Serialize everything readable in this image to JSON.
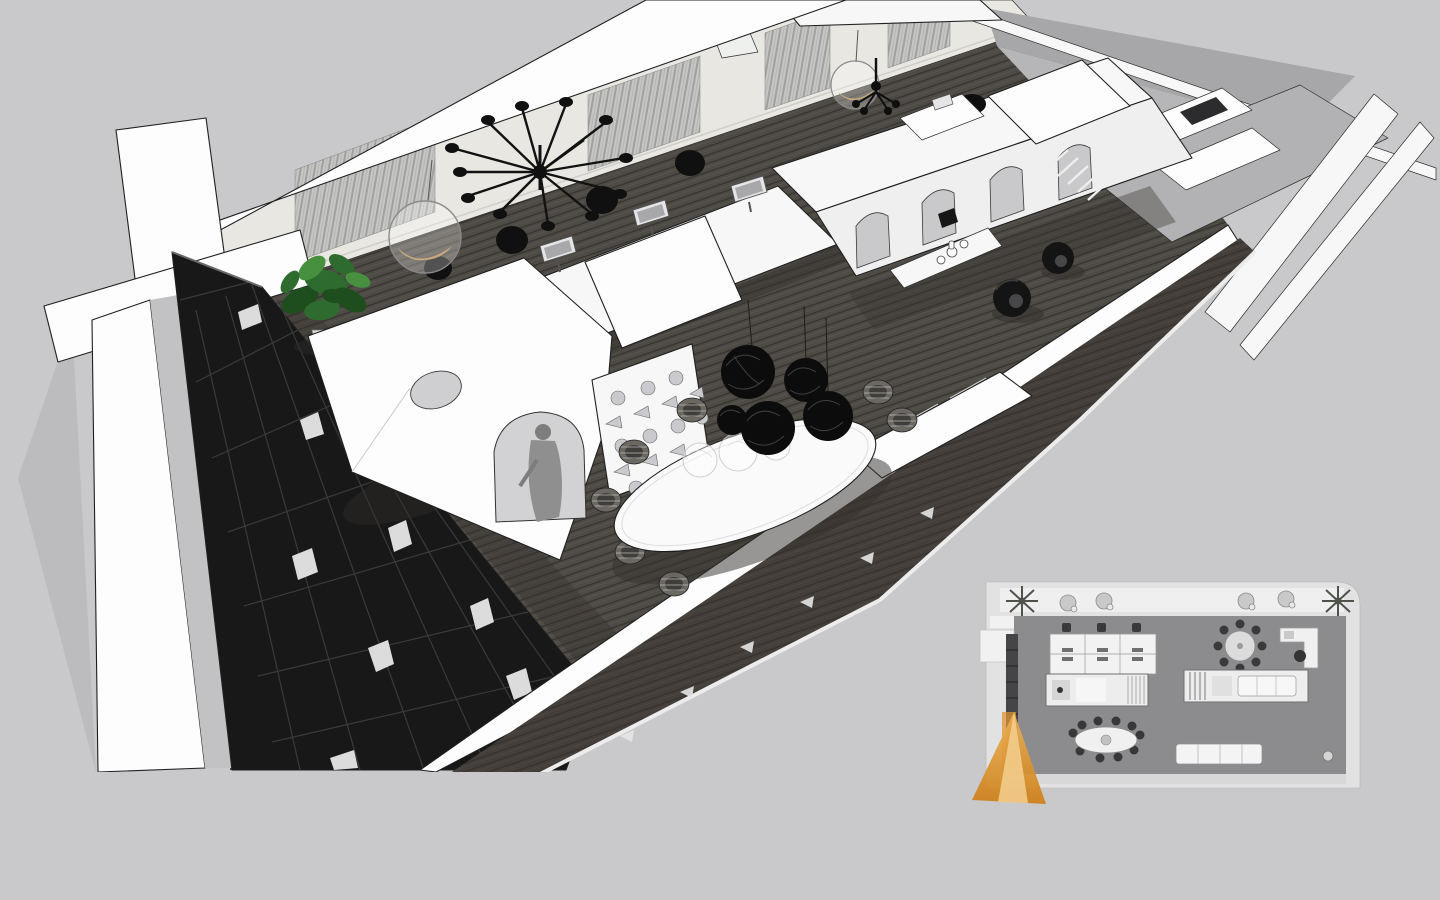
{
  "meta": {
    "view_label": "3D cutaway rendering of an open-plan office interior, SketchUp-style monochrome, seen from above at an angle",
    "inset_label": "2D floor plan inset with orange camera view-cone marker at its bottom-left corner"
  },
  "colors": {
    "background": "#c9c9cb",
    "ground_shadow": "#bcbcbe",
    "wall_white": "#f7f7f8",
    "wall_outline": "#1f1f1f",
    "backwall": "#e9e7e1",
    "curtain_base": "#c6c6c4",
    "curtain_stripe": "#a0a09e",
    "carpet": "#4e4a44",
    "carpet_shadow": "#332f2a",
    "bookshelf": "#181818",
    "bookshelf_slat": "#3a3a3a",
    "book_white": "#dcdcdc",
    "plant_dark": "#1e4d1e",
    "plant_mid": "#2e6b2e",
    "plant_light": "#46903f",
    "pot_grey": "#d8d8da",
    "furniture_white": "#fafafb",
    "furniture_side": "#e6e6e8",
    "arch_inner": "#d2d2d4",
    "monitor_frame": "#e5e5e7",
    "monitor_screen": "#a8a8aa",
    "black_accent": "#101010",
    "person_grey": "#8f8f90",
    "east_floor": "#b2b2b4",
    "roof_grey": "#a7a7a9",
    "roof_grey2": "#b6b6b8",
    "table_white": "#fafafa",
    "wire_chair": "#6b6862",
    "pendant_black": "#0c0c0c",
    "plan_wall": "#e2e2e3",
    "plan_balcony": "#efefef",
    "plan_carpet": "#8c8c8e",
    "plan_furniture_white": "#f2f2f3",
    "plan_furniture_dark": "#3a3a3c",
    "plan_shelf": "#454547",
    "cone_orange": "#df9434",
    "cone_orange_light": "#f3cf8f",
    "cone_orange_deep": "#cd7e16"
  },
  "scene": {
    "objects": [
      {
        "id": "cross-wall",
        "label": "cut wall junction forming a cross at the left end"
      },
      {
        "id": "north-window-wall",
        "label": "window wall with grey striped curtains and glazing band"
      },
      {
        "id": "bookshelf-wall",
        "label": "full-height black grid bookshelf along the near-left wall"
      },
      {
        "id": "potted-plant",
        "label": "green potted plant by the window"
      },
      {
        "id": "carpet-floor",
        "label": "dark grey striped carpet floor"
      },
      {
        "id": "workstation-desks",
        "label": "white workstation desks with monitors"
      },
      {
        "id": "task-chairs",
        "label": "black task chairs"
      },
      {
        "id": "arched-cabin-block",
        "label": "white cabin block with round cutout and arch opening"
      },
      {
        "id": "perforated-screen",
        "label": "white screen with circle and triangle perforations"
      },
      {
        "id": "standing-person",
        "label": "grey human figure inside the arch"
      },
      {
        "id": "spider-chandelier",
        "label": "black multi-arm spider chandelier"
      },
      {
        "id": "bubble-chairs",
        "label": "transparent hanging bubble chairs with tan cushions"
      },
      {
        "id": "mini-chandelier",
        "label": "small black candle chandelier"
      },
      {
        "id": "arched-arcade",
        "label": "long white arcade partition with arched openings"
      },
      {
        "id": "sideboard-vases",
        "label": "white sideboard with small vases"
      },
      {
        "id": "loop-lounge-chairs",
        "label": "black sculptural loop lounge chairs"
      },
      {
        "id": "oval-meeting-table",
        "label": "white oval meeting table with wire chairs"
      },
      {
        "id": "random-wire-pendants",
        "label": "cluster of black wireframe sphere pendant lamps"
      },
      {
        "id": "white-wall-bench",
        "label": "white bench sofa against the lower wall"
      },
      {
        "id": "far-room",
        "label": "far room with grey floor and media furniture"
      },
      {
        "id": "south-wall-band",
        "label": "cut lower wall band with outer balcony strip"
      },
      {
        "id": "east-balcony-bands",
        "label": "east end parapet bands"
      }
    ]
  },
  "floor_plan": {
    "position": "bottom-right inset",
    "camera_marker": {
      "shape": "orange view cone",
      "location": "bottom-left corner of plan",
      "direction": "pointing down-left toward viewer"
    },
    "furniture": [
      {
        "id": "plan-balcony",
        "label": "balcony strip with two palm planters and four lounge chairs"
      },
      {
        "id": "plan-bookshelf",
        "label": "bookshelf strip on left wall"
      },
      {
        "id": "plan-workstations",
        "label": "grid of six workstations with chairs"
      },
      {
        "id": "plan-round-table",
        "label": "round table with eight chairs"
      },
      {
        "id": "plan-kitchen-counter",
        "label": "L-shaped counter with armchair"
      },
      {
        "id": "plan-storage-room",
        "label": "storage room block"
      },
      {
        "id": "plan-lounge-room",
        "label": "lounge room block with sofa"
      },
      {
        "id": "plan-oval-table",
        "label": "oval table with ten chairs"
      },
      {
        "id": "plan-wall-sofa",
        "label": "long sofa on lower wall"
      },
      {
        "id": "plan-planter-ball",
        "label": "round planter in lower-right corner"
      }
    ]
  }
}
